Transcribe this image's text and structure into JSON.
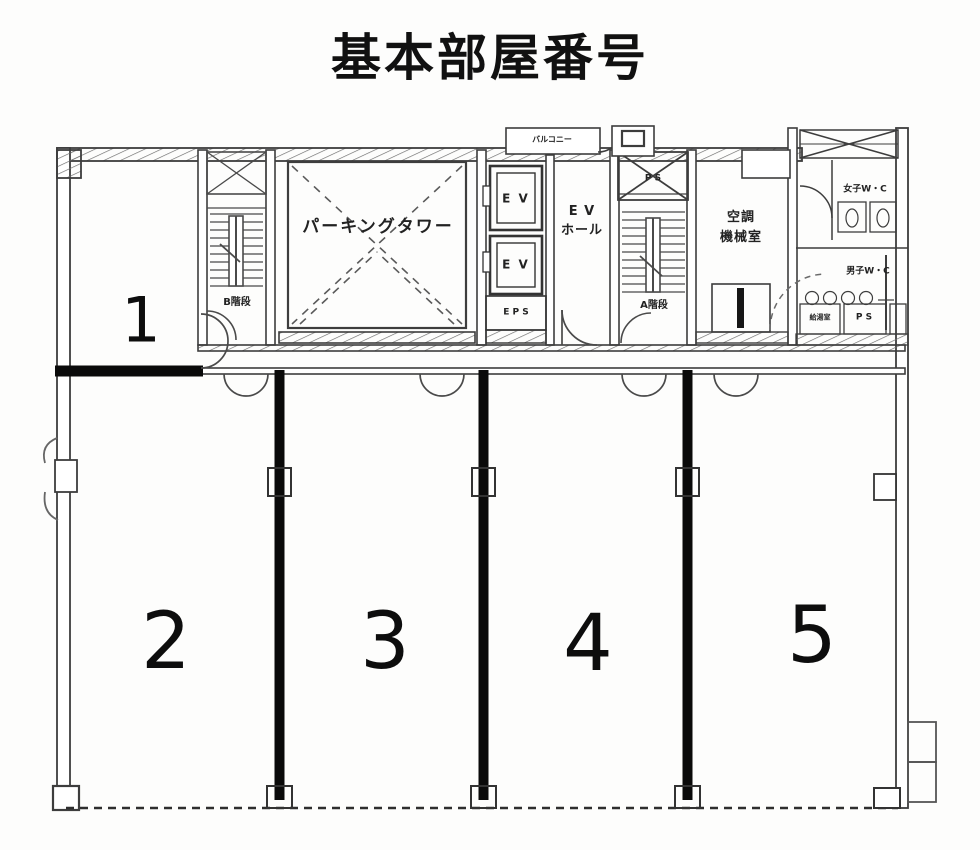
{
  "title": "基本部屋番号",
  "colors": {
    "ink": "#3d3d3d",
    "thick_line": "#0a0a0a",
    "paper": "#fdfdfc"
  },
  "floor_plan": {
    "rooms": [
      {
        "id": "room-1",
        "number": "1"
      },
      {
        "id": "room-2",
        "number": "2"
      },
      {
        "id": "room-3",
        "number": "3"
      },
      {
        "id": "room-4",
        "number": "4"
      },
      {
        "id": "room-5",
        "number": "5"
      }
    ],
    "labels": {
      "parking_tower": "パーキングタワー",
      "stairs_b": "B階段",
      "stairs_a": "A階段",
      "elevator_1": "E V",
      "elevator_2": "E V",
      "ev_hall_line1": "E V",
      "ev_hall_line2": "ホール",
      "eps": "E P S",
      "ps_shaft": "P S",
      "hvac_line1": "空調",
      "hvac_line2": "機械室",
      "womens_wc": "女子W・C",
      "mens_wc": "男子W・C",
      "pantry": "給湯室",
      "ps_small": "P S",
      "balcony": "バルコニー"
    }
  }
}
